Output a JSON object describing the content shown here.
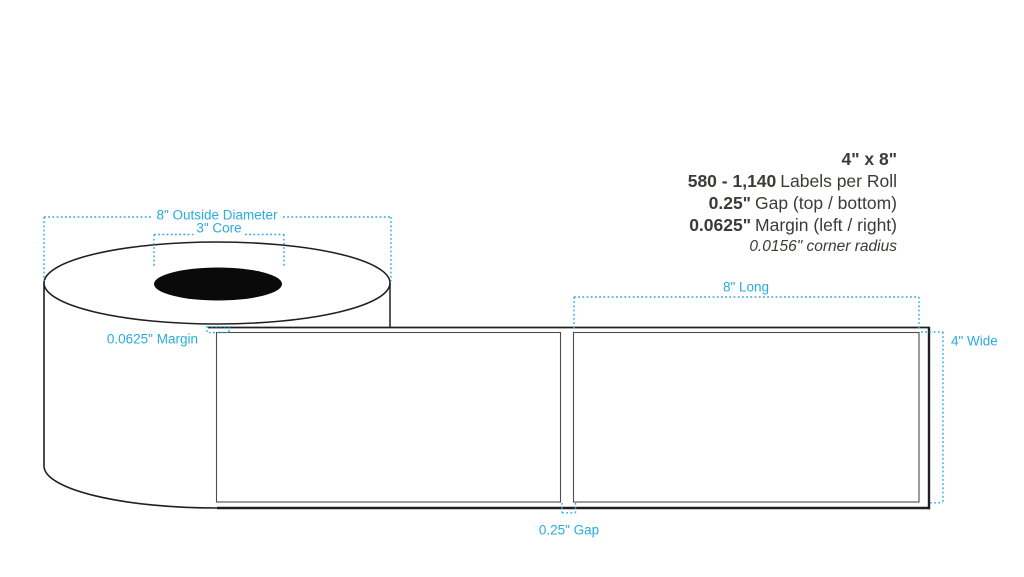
{
  "specs": {
    "size": "4\" x 8\"",
    "quantity_value": "580 - 1,140",
    "quantity_label": "Labels per Roll",
    "gap_value": "0.25\"",
    "gap_label": "Gap (top / bottom)",
    "margin_value": "0.0625\"",
    "margin_label": "Margin (left / right)",
    "corner_radius": "0.0156\" corner radius"
  },
  "dimension_labels": {
    "outside_diameter": "8\" Outside Diameter",
    "core": "3\" Core",
    "liner_margin": "0.0625\" Margin",
    "label_length": "8\" Long",
    "label_width": "4\" Wide",
    "label_gap": "0.25\" Gap"
  },
  "colors": {
    "dimension_blue": "#29ABE2",
    "spec_text_dark": "#3E3A36",
    "outline_dark": "#231F20",
    "label_stroke_gray": "#4D4D4D",
    "core_black": "#0A0A0A"
  }
}
